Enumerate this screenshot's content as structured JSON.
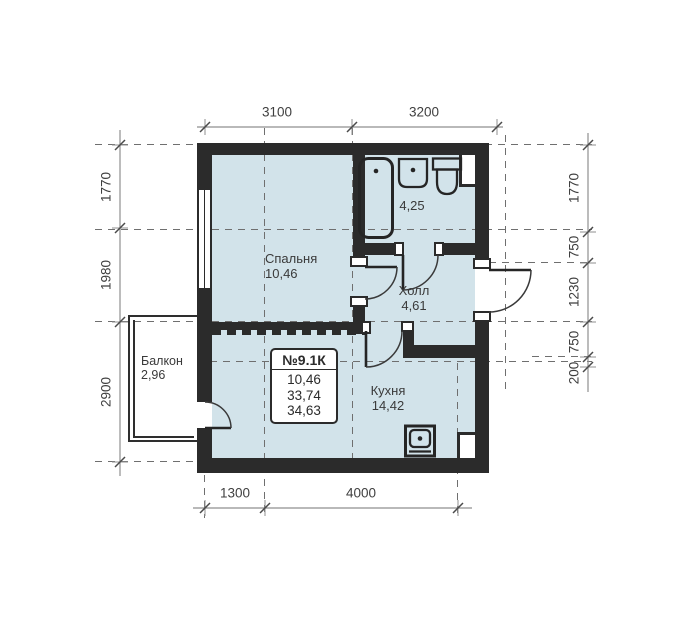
{
  "unit_box": {
    "title": "№9.1К",
    "values": [
      "10,46",
      "33,74",
      "34,63"
    ]
  },
  "rooms": {
    "bedroom": {
      "name": "Спальня",
      "area": "10,46"
    },
    "bathroom": {
      "area": "4,25"
    },
    "hall": {
      "name": "Холл",
      "area": "4,61"
    },
    "kitchen": {
      "name": "Кухня",
      "area": "14,42"
    },
    "balcony": {
      "name": "Балкон",
      "area": "2,96"
    }
  },
  "dimensions": {
    "top": [
      "3100",
      "3200"
    ],
    "bottom": [
      "1300",
      "4000"
    ],
    "left": [
      "1770",
      "1980",
      "2900"
    ],
    "right": [
      "1770",
      "750",
      "1230",
      "750",
      "200"
    ]
  },
  "fixtures": [
    "bathtub",
    "washbasin",
    "toilet",
    "kitchen-sink"
  ],
  "colors": {
    "floor_fill": "#d2e3ea",
    "wall": "#2b2b2b",
    "dimension_line": "#8f8f8f",
    "label_text": "#3b3b3b"
  }
}
